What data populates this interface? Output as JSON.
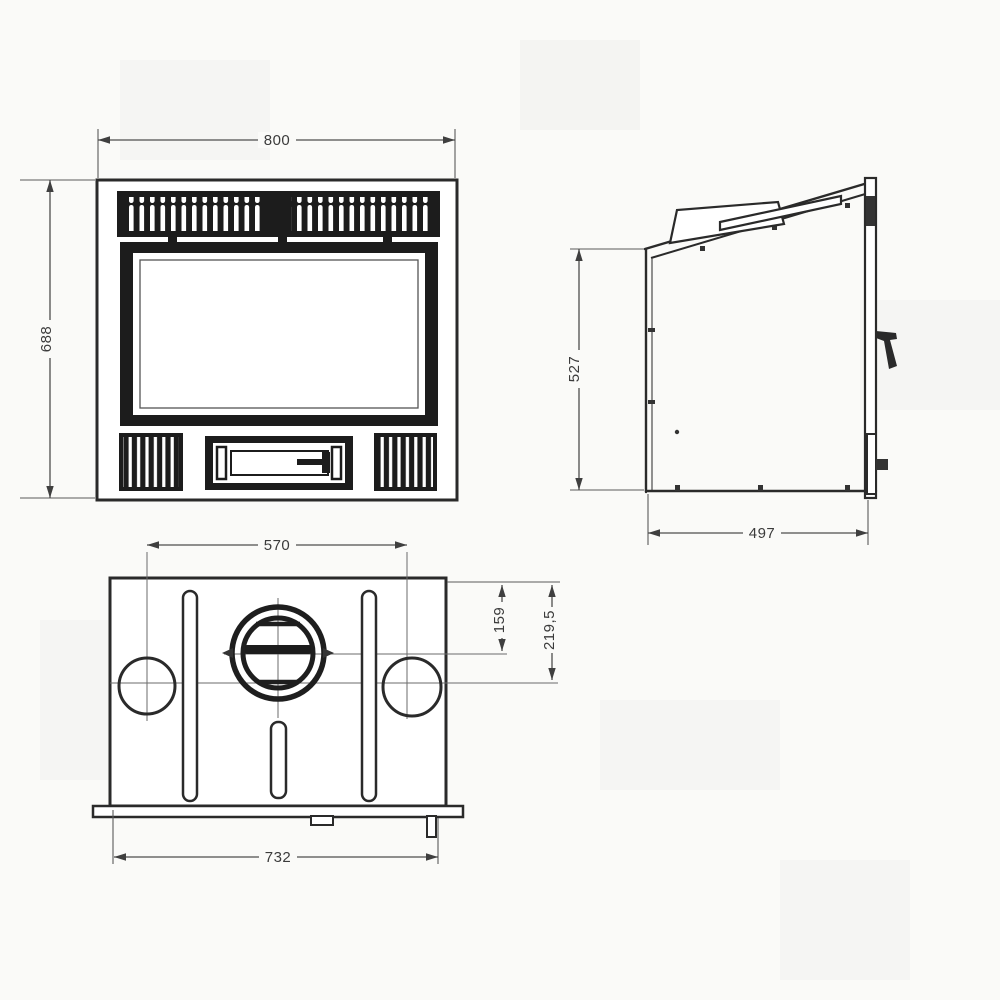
{
  "colors": {
    "ink": "#2a2a2a",
    "dimension_ink": "#4d4d4d",
    "paper": "#fafaf8",
    "glass_fill": "#ffffff",
    "grille_fill": "#1c1c1c"
  },
  "dimensions": {
    "front": {
      "width": "800",
      "height": "688"
    },
    "side": {
      "height": "527",
      "depth": "497"
    },
    "top": {
      "duct_centers_spacing": "570",
      "overall_width": "732",
      "flue_center_from_back": "159",
      "duct_center_from_back": "219,5"
    }
  }
}
